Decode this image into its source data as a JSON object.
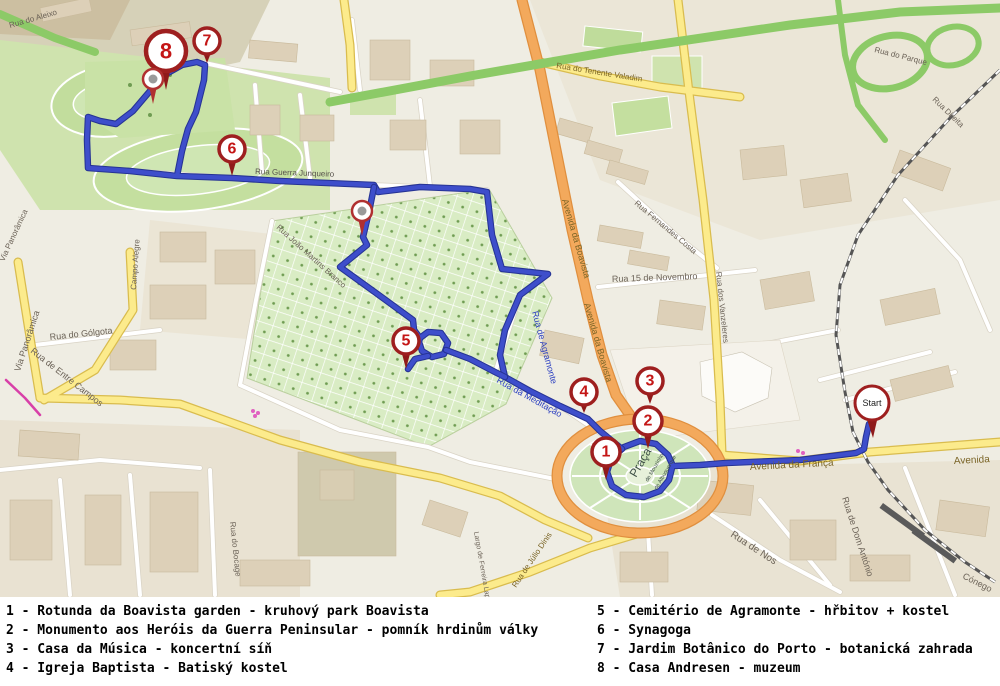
{
  "map": {
    "colors": {
      "route": "#3e4ecb",
      "route_casing": "#263394",
      "marker_ring": "#9e1f1f",
      "marker_number": "#c41616",
      "marker_tail": "#8f1a1a",
      "pin_dot": "#9a9a9a",
      "road_yellow": "#fceb8c",
      "road_orange": "#f3a95c",
      "highway_green": "#8cca67",
      "park_green": "#cfe5ba",
      "cemetery_green": "#d9ecc4",
      "label_gray": "#6b6257",
      "label_blue": "#2b3fc0",
      "label_road": "#7a6426",
      "praca_text": "#3f5147",
      "railway": "#555555",
      "tram_magenta": "#d840a8"
    },
    "routes": [
      [
        [
          869,
          424
        ],
        [
          866,
          437
        ],
        [
          864,
          449
        ],
        [
          856,
          453
        ],
        [
          800,
          460
        ],
        [
          726,
          463
        ],
        [
          700,
          465
        ],
        [
          673,
          466
        ],
        [
          668,
          455
        ],
        [
          656,
          444
        ],
        [
          640,
          441
        ],
        [
          624,
          447
        ],
        [
          611,
          459
        ],
        [
          607,
          472
        ],
        [
          612,
          486
        ],
        [
          626,
          495
        ],
        [
          644,
          497
        ],
        [
          660,
          491
        ],
        [
          669,
          480
        ],
        [
          672,
          468
        ]
      ],
      [
        [
          622,
          449
        ],
        [
          600,
          431
        ],
        [
          588,
          419
        ],
        [
          560,
          406
        ],
        [
          530,
          391
        ],
        [
          505,
          377
        ],
        [
          500,
          355
        ],
        [
          505,
          330
        ],
        [
          520,
          295
        ],
        [
          548,
          274
        ],
        [
          502,
          269
        ],
        [
          492,
          235
        ],
        [
          487,
          192
        ],
        [
          470,
          189
        ],
        [
          420,
          187
        ],
        [
          378,
          192
        ],
        [
          374,
          185
        ],
        [
          280,
          181
        ],
        [
          232,
          178
        ],
        [
          177,
          176
        ],
        [
          130,
          171
        ],
        [
          88,
          168
        ],
        [
          87,
          140
        ],
        [
          88,
          117
        ],
        [
          100,
          121
        ],
        [
          116,
          124
        ],
        [
          133,
          111
        ],
        [
          150,
          91
        ],
        [
          166,
          74
        ],
        [
          182,
          65
        ],
        [
          197,
          62
        ],
        [
          205,
          65
        ],
        [
          204,
          80
        ],
        [
          196,
          112
        ],
        [
          188,
          129
        ],
        [
          182,
          151
        ],
        [
          177,
          176
        ]
      ],
      [
        [
          374,
          187
        ],
        [
          369,
          212
        ],
        [
          363,
          237
        ],
        [
          367,
          245
        ],
        [
          340,
          267
        ],
        [
          376,
          293
        ],
        [
          413,
          320
        ],
        [
          414,
          330
        ],
        [
          420,
          338
        ],
        [
          428,
          332
        ],
        [
          441,
          333
        ],
        [
          448,
          343
        ],
        [
          444,
          354
        ],
        [
          432,
          357
        ],
        [
          422,
          351
        ],
        [
          419,
          342
        ],
        [
          420,
          338
        ]
      ],
      [
        [
          446,
          350
        ],
        [
          470,
          359
        ],
        [
          495,
          372
        ],
        [
          505,
          377
        ]
      ],
      [
        [
          428,
          356
        ],
        [
          415,
          359
        ],
        [
          408,
          369
        ]
      ]
    ],
    "markers": [
      {
        "n": "1",
        "x": 606,
        "y": 452,
        "tip": 480,
        "r": 14
      },
      {
        "n": "2",
        "x": 648,
        "y": 421,
        "tip": 449,
        "r": 14
      },
      {
        "n": "3",
        "x": 650,
        "y": 381,
        "tip": 404,
        "r": 13
      },
      {
        "n": "4",
        "x": 584,
        "y": 392,
        "tip": 413,
        "r": 13
      },
      {
        "n": "5",
        "x": 406,
        "y": 341,
        "tip": 369,
        "r": 13
      },
      {
        "n": "6",
        "x": 232,
        "y": 149,
        "tip": 176,
        "r": 13
      },
      {
        "n": "7",
        "x": 207,
        "y": 41,
        "tip": 63,
        "r": 13
      },
      {
        "n": "8",
        "x": 166,
        "y": 51,
        "tip": 90,
        "r": 20
      }
    ],
    "photo_pins": [
      {
        "x": 153,
        "y": 79,
        "tip": 104
      },
      {
        "x": 362,
        "y": 211,
        "tip": 236
      }
    ],
    "start_marker": {
      "label": "Start",
      "x": 872,
      "y": 403,
      "tip": 438,
      "r": 17
    },
    "street_labels": [
      {
        "t": "Rua do Aleixo",
        "x": 10,
        "y": 28,
        "r": -16,
        "s": 8,
        "c": "#6b6257"
      },
      {
        "t": "Via Panorâmica",
        "x": 20,
        "y": 372,
        "r": -72,
        "s": 9,
        "c": "#6b6257"
      },
      {
        "t": "Via Panorâmica",
        "x": 4,
        "y": 262,
        "r": -65,
        "s": 8,
        "c": "#6b6257"
      },
      {
        "t": "Rua do Gólgota",
        "x": 50,
        "y": 340,
        "r": -6,
        "s": 9,
        "c": "#6b6257"
      },
      {
        "t": "Rua de Entre Campos",
        "x": 30,
        "y": 352,
        "r": 38,
        "s": 9,
        "c": "#6b6257"
      },
      {
        "t": "Campo Alegre",
        "x": 136,
        "y": 290,
        "r": -86,
        "s": 8,
        "c": "#6b6257"
      },
      {
        "t": "Rua do Bocage",
        "x": 230,
        "y": 522,
        "r": 84,
        "s": 8,
        "c": "#6b6257"
      },
      {
        "t": "Rua Guerra Junqueiro",
        "x": 255,
        "y": 174,
        "r": 2,
        "s": 8,
        "c": "#55504a"
      },
      {
        "t": "Rua João Martins Branco",
        "x": 276,
        "y": 228,
        "r": 42,
        "s": 8,
        "c": "#6b6257"
      },
      {
        "t": "Rua de Agramonte",
        "x": 532,
        "y": 312,
        "r": 75,
        "s": 9,
        "c": "#2b3fc0"
      },
      {
        "t": "Rua da Meditação",
        "x": 496,
        "y": 382,
        "r": 29,
        "s": 9,
        "c": "#2b3fc0"
      },
      {
        "t": "Avenida da Boavista",
        "x": 562,
        "y": 200,
        "r": 74,
        "s": 9,
        "c": "#7a6426"
      },
      {
        "t": "Avenida da Boavista",
        "x": 584,
        "y": 304,
        "r": 74,
        "s": 9,
        "c": "#7a6426"
      },
      {
        "t": "Rua 15 de Novembro",
        "x": 612,
        "y": 282,
        "r": -2,
        "s": 9,
        "c": "#6b6257"
      },
      {
        "t": "Rua Fernandes Costa",
        "x": 634,
        "y": 204,
        "r": 40,
        "s": 8,
        "c": "#6b6257"
      },
      {
        "t": "Rua dos Vanzeleres",
        "x": 716,
        "y": 272,
        "r": 84,
        "s": 8,
        "c": "#6b6257"
      },
      {
        "t": "Rua do Tenente Valadim",
        "x": 556,
        "y": 68,
        "r": 9,
        "s": 8,
        "c": "#7a6426"
      },
      {
        "t": "Rua do Parque",
        "x": 874,
        "y": 52,
        "r": 14,
        "s": 8,
        "c": "#6b6257"
      },
      {
        "t": "Rua Direita",
        "x": 932,
        "y": 100,
        "r": 44,
        "s": 8,
        "c": "#6b6257"
      },
      {
        "t": "Avenida da França",
        "x": 750,
        "y": 470,
        "r": -3,
        "s": 10,
        "c": "#7a6426"
      },
      {
        "t": "Avenida",
        "x": 954,
        "y": 464,
        "r": -3,
        "s": 10,
        "c": "#7a6426"
      },
      {
        "t": "Rua de Júlio Dinis",
        "x": 516,
        "y": 588,
        "r": -56,
        "s": 8,
        "c": "#7a6426"
      },
      {
        "t": "Largo de Ferreira Lapa",
        "x": 474,
        "y": 532,
        "r": 80,
        "s": 7,
        "c": "#6b6257"
      },
      {
        "t": "Rua de Dom António",
        "x": 842,
        "y": 498,
        "r": 72,
        "s": 9,
        "c": "#6b6257"
      },
      {
        "t": "Rua de Nos",
        "x": 730,
        "y": 536,
        "r": 33,
        "s": 10,
        "c": "#6b6257"
      },
      {
        "t": "Cónego",
        "x": 962,
        "y": 578,
        "r": 27,
        "s": 9,
        "c": "#6b6257"
      },
      {
        "t": "Praça",
        "x": 636,
        "y": 478,
        "r": -60,
        "s": 12,
        "c": "#3f5147"
      },
      {
        "t": "de Mouzinho",
        "x": 648,
        "y": 482,
        "r": -60,
        "s": 5.5,
        "c": "#3f5147"
      },
      {
        "t": "de Albuquerque",
        "x": 657,
        "y": 490,
        "r": -60,
        "s": 5.5,
        "c": "#3f5147"
      }
    ]
  },
  "legend": {
    "left": [
      "1 - Rotunda da Boavista garden - kruhový park Boavista",
      "2 - Monumento aos Heróis da Guerra Peninsular - pomník hrdinům války",
      "3 - Casa da Música - koncertní síň",
      "4 - Igreja Baptista - Batiský kostel"
    ],
    "right": [
      "5 - Cemitério de Agramonte - hřbitov + kostel",
      "6 - Synagoga",
      "7 - Jardim Botânico do Porto - botanická zahrada",
      "8 - Casa Andresen - muzeum"
    ]
  }
}
